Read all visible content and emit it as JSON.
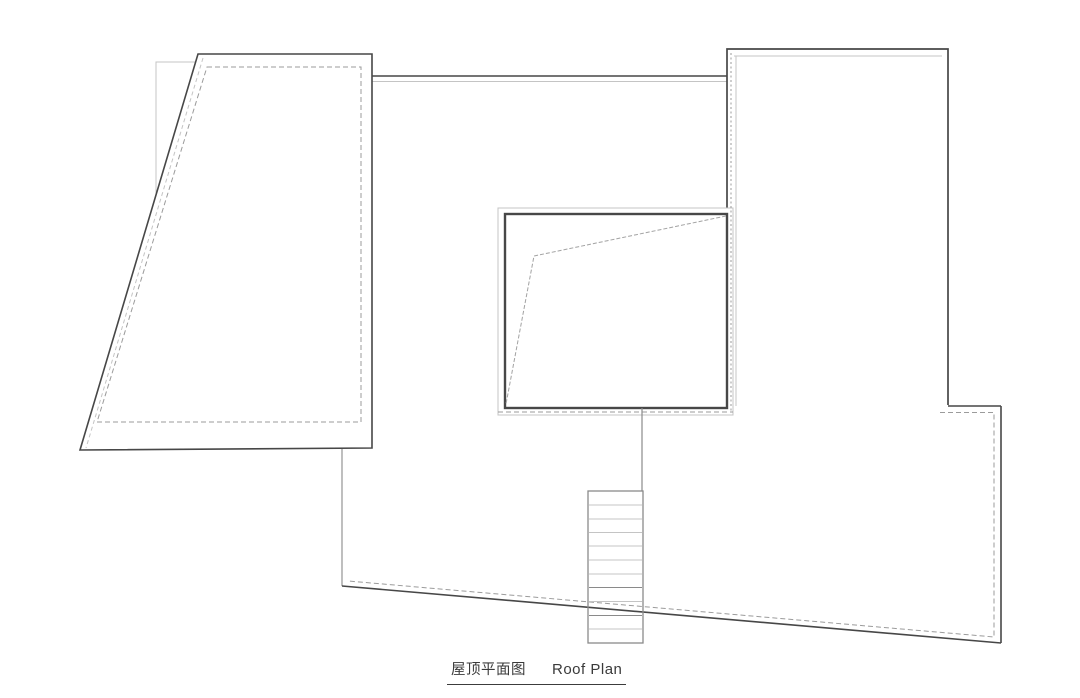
{
  "page": {
    "width": 1080,
    "height": 693,
    "background": "#ffffff"
  },
  "title": {
    "cn": "屋顶平面图",
    "en": "Roof Plan"
  },
  "colors": {
    "dark": "#474747",
    "medium": "#8a8a8a",
    "light": "#c4c4c4",
    "dash": "#9b9b9b",
    "diag": "#a2a2a2",
    "white": "#ffffff"
  },
  "drawing": {
    "shapes": [
      {
        "name": "lower-roof-fill",
        "kind": "polygon",
        "points": [
          [
            372,
            76
          ],
          [
            948,
            76
          ],
          [
            948,
            406
          ],
          [
            1001,
            406
          ],
          [
            1001,
            643
          ],
          [
            342,
            586
          ],
          [
            342,
            449
          ],
          [
            372,
            449
          ]
        ],
        "fill": "white",
        "stroke": "none",
        "sw": 0
      },
      {
        "name": "lower-roof-top-edge",
        "kind": "line",
        "x1": 372,
        "y1": 76,
        "x2": 727,
        "y2": 76,
        "stroke": "dark",
        "sw": 1.6
      },
      {
        "name": "lower-roof-top-edge-inner",
        "kind": "line",
        "x1": 372,
        "y1": 81.5,
        "x2": 727,
        "y2": 81.5,
        "stroke": "light",
        "sw": 1
      },
      {
        "name": "lower-roof-left-edge",
        "kind": "line",
        "x1": 342,
        "y1": 449,
        "x2": 342,
        "y2": 586,
        "stroke": "medium",
        "sw": 1.1
      },
      {
        "name": "lower-roof-bottom-edge",
        "kind": "line",
        "x1": 342,
        "y1": 586,
        "x2": 1001,
        "y2": 643,
        "stroke": "dark",
        "sw": 1.6
      },
      {
        "name": "lower-roof-right-edge",
        "kind": "line",
        "x1": 1001,
        "y1": 406,
        "x2": 1001,
        "y2": 643,
        "stroke": "dark",
        "sw": 1.6
      },
      {
        "name": "lower-roof-step-edge",
        "kind": "line",
        "x1": 948,
        "y1": 406,
        "x2": 1001,
        "y2": 406,
        "stroke": "dark",
        "sw": 1.6
      },
      {
        "name": "lower-roof-dashed-inset",
        "kind": "polyline",
        "points": [
          [
            940,
            412.5
          ],
          [
            994,
            412.5
          ],
          [
            994,
            637
          ],
          [
            348,
            581
          ]
        ],
        "fill": "none",
        "stroke": "dash",
        "sw": 1,
        "dash": "5,3"
      },
      {
        "name": "background-parapet-rect",
        "kind": "rect",
        "x": 156,
        "y": 62,
        "w": 134,
        "h": 140,
        "fill": "none",
        "stroke": "light",
        "sw": 1
      },
      {
        "name": "trapezoid-roof-panel",
        "kind": "polygon",
        "points": [
          [
            198,
            54
          ],
          [
            372,
            54
          ],
          [
            372,
            448
          ],
          [
            80,
            450
          ]
        ],
        "fill": "white",
        "stroke": "dark",
        "sw": 1.6
      },
      {
        "name": "trapezoid-slant-inner-line",
        "kind": "line",
        "x1": 203,
        "y1": 58,
        "x2": 86,
        "y2": 448,
        "stroke": "light",
        "sw": 1,
        "dash": "4,3"
      },
      {
        "name": "trapezoid-dashed-inset",
        "kind": "polygon",
        "points": [
          [
            207,
            67
          ],
          [
            361,
            67
          ],
          [
            361,
            422
          ],
          [
            97,
            422
          ]
        ],
        "fill": "none",
        "stroke": "dash",
        "sw": 1,
        "dash": "5,3"
      },
      {
        "name": "upper-right-roof-fill",
        "kind": "polygon",
        "points": [
          [
            727,
            49
          ],
          [
            948,
            49
          ],
          [
            948,
            406
          ],
          [
            727,
            406
          ]
        ],
        "fill": "white",
        "stroke": "none",
        "sw": 0
      },
      {
        "name": "upper-right-roof-outline",
        "kind": "polyline",
        "points": [
          [
            727,
            408
          ],
          [
            727,
            49
          ],
          [
            948,
            49
          ],
          [
            948,
            405
          ]
        ],
        "fill": "none",
        "stroke": "dark",
        "sw": 1.7
      },
      {
        "name": "upper-right-roof-inner-top",
        "kind": "line",
        "x1": 734,
        "y1": 56,
        "x2": 942,
        "y2": 56,
        "stroke": "light",
        "sw": 1
      },
      {
        "name": "upper-right-roof-inner-left",
        "kind": "line",
        "x1": 736,
        "y1": 56,
        "x2": 736,
        "y2": 406,
        "stroke": "light",
        "sw": 1
      },
      {
        "name": "skylight-outer-rect",
        "kind": "rect",
        "x": 498,
        "y": 208,
        "w": 235,
        "h": 207,
        "fill": "white",
        "stroke": "light",
        "sw": 1
      },
      {
        "name": "skylight-inner-rect",
        "kind": "rect",
        "x": 505,
        "y": 214,
        "w": 222,
        "h": 194,
        "fill": "none",
        "stroke": "dark",
        "sw": 2.4
      },
      {
        "name": "skylight-ridge-line",
        "kind": "polyline",
        "points": [
          [
            726,
            216
          ],
          [
            534,
            256
          ],
          [
            506,
            404
          ]
        ],
        "fill": "none",
        "stroke": "diag",
        "sw": 1,
        "dash": "4,2"
      },
      {
        "name": "dashed-line-right-of-skylight",
        "kind": "line",
        "x1": 731,
        "y1": 53,
        "x2": 731,
        "y2": 412,
        "stroke": "dash",
        "sw": 1,
        "dash": "2,2.5"
      },
      {
        "name": "dashed-line-below-skylight",
        "kind": "line",
        "x1": 498,
        "y1": 412,
        "x2": 733,
        "y2": 412,
        "stroke": "dash",
        "sw": 1,
        "dash": "5,3"
      },
      {
        "name": "stair-connector-line",
        "kind": "line",
        "x1": 642,
        "y1": 408,
        "x2": 642,
        "y2": 491,
        "stroke": "medium",
        "sw": 1.2
      },
      {
        "name": "stair-outline",
        "kind": "rect",
        "x": 588,
        "y": 491,
        "w": 55,
        "h": 152,
        "fill": "none",
        "stroke": "medium",
        "sw": 1.3
      },
      {
        "name": "stair-tread",
        "kind": "line",
        "x1": 589,
        "y1": 505,
        "x2": 642,
        "y2": 505,
        "stroke": "light",
        "sw": 1
      },
      {
        "name": "stair-tread",
        "kind": "line",
        "x1": 589,
        "y1": 519,
        "x2": 642,
        "y2": 519,
        "stroke": "light",
        "sw": 1
      },
      {
        "name": "stair-tread",
        "kind": "line",
        "x1": 589,
        "y1": 532.5,
        "x2": 642,
        "y2": 532.5,
        "stroke": "light",
        "sw": 1
      },
      {
        "name": "stair-tread",
        "kind": "line",
        "x1": 589,
        "y1": 546,
        "x2": 642,
        "y2": 546,
        "stroke": "light",
        "sw": 1
      },
      {
        "name": "stair-tread",
        "kind": "line",
        "x1": 589,
        "y1": 560,
        "x2": 642,
        "y2": 560,
        "stroke": "light",
        "sw": 1
      },
      {
        "name": "stair-tread",
        "kind": "line",
        "x1": 589,
        "y1": 574,
        "x2": 642,
        "y2": 574,
        "stroke": "light",
        "sw": 1
      },
      {
        "name": "stair-tread",
        "kind": "line",
        "x1": 589,
        "y1": 587.5,
        "x2": 642,
        "y2": 587.5,
        "stroke": "medium",
        "sw": 1
      },
      {
        "name": "stair-tread",
        "kind": "line",
        "x1": 589,
        "y1": 601.5,
        "x2": 642,
        "y2": 601.5,
        "stroke": "light",
        "sw": 1
      },
      {
        "name": "stair-tread",
        "kind": "line",
        "x1": 589,
        "y1": 615.5,
        "x2": 642,
        "y2": 615.5,
        "stroke": "medium",
        "sw": 1
      },
      {
        "name": "stair-tread",
        "kind": "line",
        "x1": 589,
        "y1": 629,
        "x2": 642,
        "y2": 629,
        "stroke": "light",
        "sw": 1
      }
    ]
  }
}
